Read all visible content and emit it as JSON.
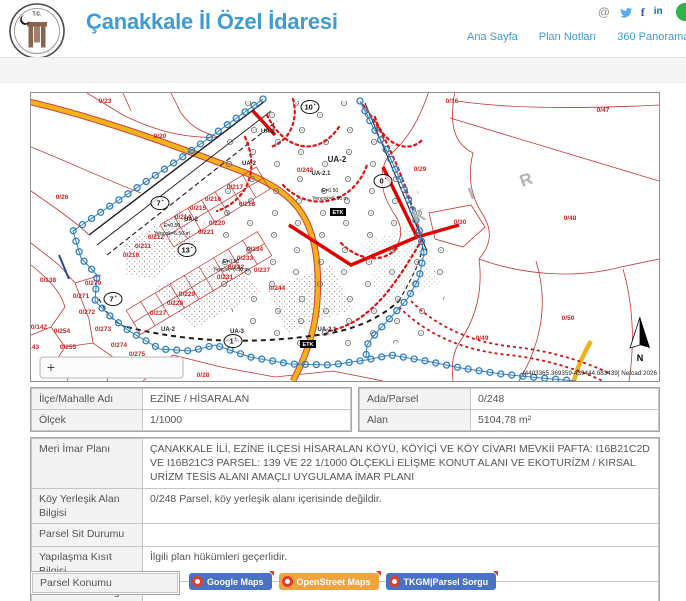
{
  "header": {
    "title": "Çanakkale İl Özel İdaresi",
    "logo": {
      "top_text": "T.C."
    },
    "icons": {
      "email": "@",
      "facebook": "f",
      "linkedin": "in"
    },
    "nav": [
      {
        "label": "Ana Sayfa"
      },
      {
        "label": "Plan Notları"
      },
      {
        "label": "360 Panorama"
      },
      {
        "label": "Yaz"
      }
    ]
  },
  "map": {
    "zoom_control": "+",
    "north_label": "N",
    "attribution": "[4403365.369359-439444.083439] Netcad 2026",
    "watermark_letters": [
      {
        "t": "K",
        "x": 390,
        "y": 128
      },
      {
        "t": "I",
        "x": 442,
        "y": 106
      },
      {
        "t": "R",
        "x": 497,
        "y": 92
      }
    ],
    "circled_labels": [
      {
        "t": "10",
        "mark": "*",
        "x": 279,
        "y": 14
      },
      {
        "t": "7",
        "mark": "*",
        "x": 129,
        "y": 110
      },
      {
        "t": "7",
        "mark": "*",
        "x": 82,
        "y": 206
      },
      {
        "t": "13",
        "mark": "*",
        "x": 156,
        "y": 157
      },
      {
        "t": "1",
        "mark": "*",
        "x": 202,
        "y": 248
      },
      {
        "t": "0",
        "mark": "*",
        "x": 352,
        "y": 88
      }
    ],
    "parcel_labels": [
      {
        "t": "0/23",
        "x": 74,
        "y": 10
      },
      {
        "t": "0/20",
        "x": 129,
        "y": 45
      },
      {
        "t": "0/26",
        "x": 31,
        "y": 106
      },
      {
        "t": "0/16",
        "x": 421,
        "y": 10
      },
      {
        "t": "0/47",
        "x": 572,
        "y": 19
      },
      {
        "t": "0/29",
        "x": 389,
        "y": 78
      },
      {
        "t": "0/30",
        "x": 429,
        "y": 131
      },
      {
        "t": "0/48",
        "x": 539,
        "y": 127
      },
      {
        "t": "0/49",
        "x": 451,
        "y": 247
      },
      {
        "t": "0/50",
        "x": 537,
        "y": 227
      },
      {
        "t": "0/28",
        "x": 172,
        "y": 284
      },
      {
        "t": "0/138",
        "x": 17,
        "y": 189
      },
      {
        "t": "0/142",
        "x": 8,
        "y": 236
      },
      {
        "t": "0/143",
        "x": 0,
        "y": 256
      },
      {
        "t": "0/254",
        "x": 31,
        "y": 240
      },
      {
        "t": "0/255",
        "x": 37,
        "y": 256
      },
      {
        "t": "0/256",
        "x": 64,
        "y": 269
      },
      {
        "t": "0/270",
        "x": 62,
        "y": 192
      },
      {
        "t": "0/271",
        "x": 50,
        "y": 205
      },
      {
        "t": "0/272",
        "x": 56,
        "y": 221
      },
      {
        "t": "0/273",
        "x": 72,
        "y": 238
      },
      {
        "t": "0/274",
        "x": 88,
        "y": 254
      },
      {
        "t": "0/275",
        "x": 106,
        "y": 263
      },
      {
        "t": "0/210",
        "x": 100,
        "y": 164
      },
      {
        "t": "0/211",
        "x": 112,
        "y": 155
      },
      {
        "t": "0/212",
        "x": 125,
        "y": 146
      },
      {
        "t": "0/214",
        "x": 152,
        "y": 126
      },
      {
        "t": "0/215",
        "x": 167,
        "y": 117
      },
      {
        "t": "0/216",
        "x": 182,
        "y": 108
      },
      {
        "t": "0/217",
        "x": 204,
        "y": 96
      },
      {
        "t": "0/218",
        "x": 216,
        "y": 113
      },
      {
        "t": "0/220",
        "x": 186,
        "y": 132
      },
      {
        "t": "0/221",
        "x": 175,
        "y": 141
      },
      {
        "t": "0/227",
        "x": 127,
        "y": 222
      },
      {
        "t": "0/228",
        "x": 144,
        "y": 212
      },
      {
        "t": "0/229",
        "x": 156,
        "y": 203
      },
      {
        "t": "0/231",
        "x": 194,
        "y": 186
      },
      {
        "t": "0/232",
        "x": 205,
        "y": 176
      },
      {
        "t": "0/233",
        "x": 214,
        "y": 167
      },
      {
        "t": "0/234",
        "x": 224,
        "y": 158
      },
      {
        "t": "0/237",
        "x": 231,
        "y": 179
      },
      {
        "t": "0/244",
        "x": 246,
        "y": 197
      },
      {
        "t": "0/242",
        "x": 274,
        "y": 79
      }
    ],
    "zone_labels": [
      {
        "t": "UA-2",
        "x": 237,
        "y": 40,
        "big": false
      },
      {
        "t": "UA-2",
        "x": 218,
        "y": 72,
        "big": false
      },
      {
        "t": "UA-2",
        "x": 306,
        "y": 69,
        "big": true
      },
      {
        "t": "UA-2.1",
        "x": 290,
        "y": 82,
        "big": false
      },
      {
        "t": "UA-2",
        "x": 160,
        "y": 128,
        "big": false
      },
      {
        "t": "UA-2",
        "x": 137,
        "y": 238,
        "big": false
      },
      {
        "t": "UA-3",
        "x": 206,
        "y": 240,
        "big": false
      },
      {
        "t": "UA-2.1",
        "x": 296,
        "y": 238,
        "big": false
      }
    ],
    "note_labels": [
      {
        "t": "E=0.50",
        "x": 141,
        "y": 134
      },
      {
        "t": "Yençok=6.50 m",
        "x": 141,
        "y": 142
      },
      {
        "t": "E=0.50",
        "x": 200,
        "y": 170
      },
      {
        "t": "Yençok=6.50 m",
        "x": 200,
        "y": 178
      },
      {
        "t": "E=0.50",
        "x": 299,
        "y": 99
      },
      {
        "t": "Yençok=6.50 m",
        "x": 299,
        "y": 107
      }
    ],
    "box_labels": [
      {
        "t": "ETK",
        "x": 307,
        "y": 121
      },
      {
        "t": "ETK",
        "x": 277,
        "y": 253
      }
    ]
  },
  "info_left": {
    "rows": [
      {
        "label": "İlçe/Mahalle Adı",
        "value": "EZİNE / HİSARALAN"
      },
      {
        "label": "Ölçek",
        "value": "1/1000"
      }
    ]
  },
  "info_right": {
    "rows": [
      {
        "label": "Ada/Parsel",
        "value": "0/248"
      },
      {
        "label": "Alan",
        "value": "5104,78 m²"
      }
    ]
  },
  "details": {
    "rows": [
      {
        "label": "Meri İmar Planı",
        "value": "ÇANAKKALE İLİ, EZİNE İLÇESİ HİSARALAN KÖYÜ, KÖYİÇİ VE KÖY CİVARI MEVKİİ PAFTA: I16B21C2D VE I16B21C3 PARSEL: 139 VE 22 1/1000 ÖLÇEKLİ ELİŞME KONUT ALANI VE EKOTURİZM / KIRSAL URİZM TESİS ALANI AMAÇLI UYGULAMA İMAR PLANI"
      },
      {
        "label": "Köy Yerleşik Alan Bilgisi",
        "value": "0/248 Parsel, köy yerleşik alanı içerisinde değildir."
      },
      {
        "label": "Parsel Sit Durumu",
        "value": ""
      },
      {
        "label": "Yapılaşma Kısıt Bilgisi",
        "value": "İlgili plan hükümleri geçerlidir."
      },
      {
        "label": "Mücavir Alan Bilgisi",
        "value": ""
      }
    ]
  },
  "location": {
    "label": "Parsel Konumu",
    "buttons": [
      {
        "label": "Google Maps",
        "style": "blue"
      },
      {
        "label": "OpenStreet Maps",
        "style": "orange"
      },
      {
        "label": "TKGM|Parsel Sorgu",
        "style": "blue"
      }
    ]
  },
  "colors": {
    "accent_blue": "#3d9bd5",
    "map_red": "#c23333",
    "road_yellow": "#f2b21a",
    "chain_blue": "#2e7fc2",
    "button_blue": "#4a72c4",
    "button_orange": "#f0a33f",
    "icon_red": "#d9402a"
  }
}
